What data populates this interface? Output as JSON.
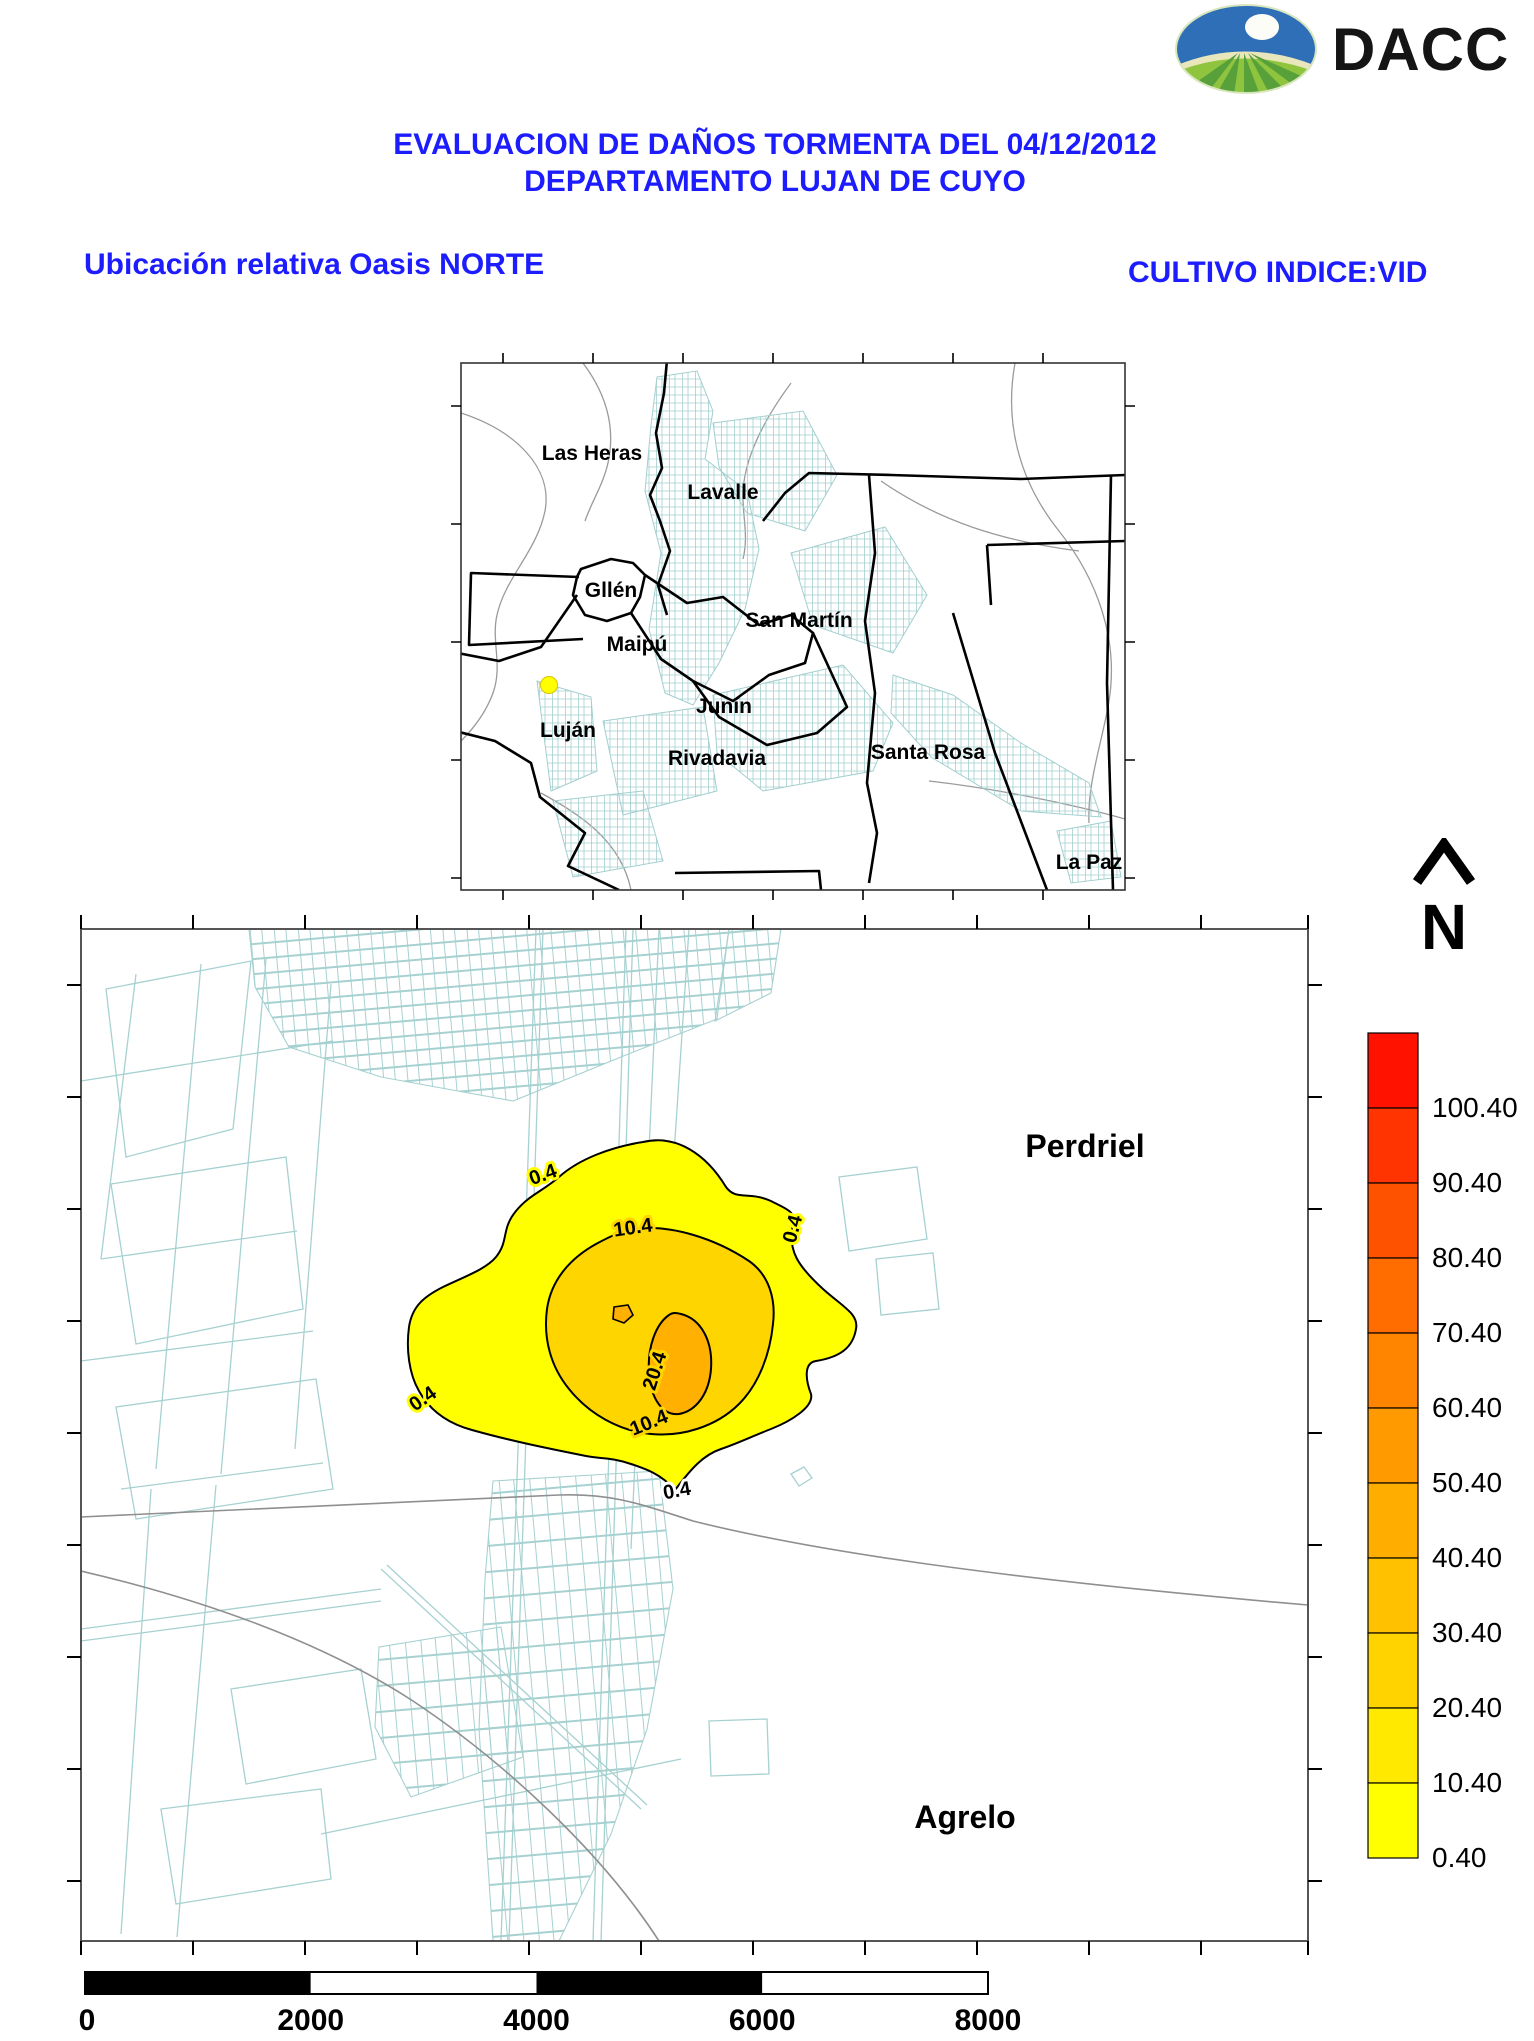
{
  "logo": {
    "text": "DACC",
    "icon": "dacc-sun-field-icon"
  },
  "header": {
    "title_line1": "EVALUACION DE DAÑOS TORMENTA DEL 04/12/2012",
    "title_line2": "DEPARTAMENTO LUJAN DE CUYO"
  },
  "subheaders": {
    "left": "Ubicación relativa Oasis NORTE",
    "right": "CULTIVO INDICE:VID"
  },
  "colors": {
    "accent_blue": "#1C1CFF",
    "parcel_teal": "#A7D1D1",
    "road_gray": "#8F8F8F",
    "storm_marker_yellow": "#FFFF00"
  },
  "inset_map": {
    "department_labels": [
      "Las Heras",
      "Lavalle",
      "Gllén",
      "Maipú",
      "San Martín",
      "Junín",
      "Luján",
      "Rivadavia",
      "Santa Rosa",
      "La Paz"
    ]
  },
  "main_map": {
    "place_labels": {
      "north": "Perdriel",
      "south": "Agrelo"
    },
    "contour_labels": [
      "0.4",
      "10.4",
      "0.4",
      "20.4",
      "0.4",
      "10.4",
      "0.4"
    ],
    "region_colors": {
      "outer": "#FFFF00",
      "middle": "#FFD500",
      "inner": "#FFB000"
    }
  },
  "north_arrow": {
    "label": "N"
  },
  "legend": {
    "tick_labels": [
      "100.40",
      "90.40",
      "80.40",
      "70.40",
      "60.40",
      "50.40",
      "40.40",
      "30.40",
      "20.40",
      "10.40",
      "0.40"
    ],
    "cell_colors_top_to_bottom": [
      "#FF1200",
      "#FF3400",
      "#FF5200",
      "#FF6C00",
      "#FF8400",
      "#FF9A00",
      "#FFAE00",
      "#FFC100",
      "#FFD300",
      "#FFE900",
      "#FFFF00"
    ]
  },
  "scale_bar": {
    "tick_labels": [
      "0",
      "2000",
      "4000",
      "6000",
      "8000"
    ]
  },
  "chart_data": {
    "type": "heatmap",
    "subtype": "damage-contour-map",
    "title": "EVALUACION DE DAÑOS TORMENTA DEL 04/12/2012 DEPARTAMENTO LUJAN DE CUYO",
    "crop_index": "VID",
    "contour_levels": [
      0.4,
      10.4,
      20.4
    ],
    "legend_ticks": [
      0.4,
      10.4,
      20.4,
      30.4,
      40.4,
      50.4,
      60.4,
      70.4,
      80.4,
      90.4,
      100.4
    ],
    "scale_bar_values": [
      0,
      2000,
      4000,
      6000,
      8000
    ],
    "inset_departments": [
      "Las Heras",
      "Lavalle",
      "Gllén",
      "Maipú",
      "San Martín",
      "Junín",
      "Luján",
      "Rivadavia",
      "Santa Rosa",
      "La Paz"
    ],
    "main_map_places": [
      "Perdriel",
      "Agrelo"
    ]
  }
}
